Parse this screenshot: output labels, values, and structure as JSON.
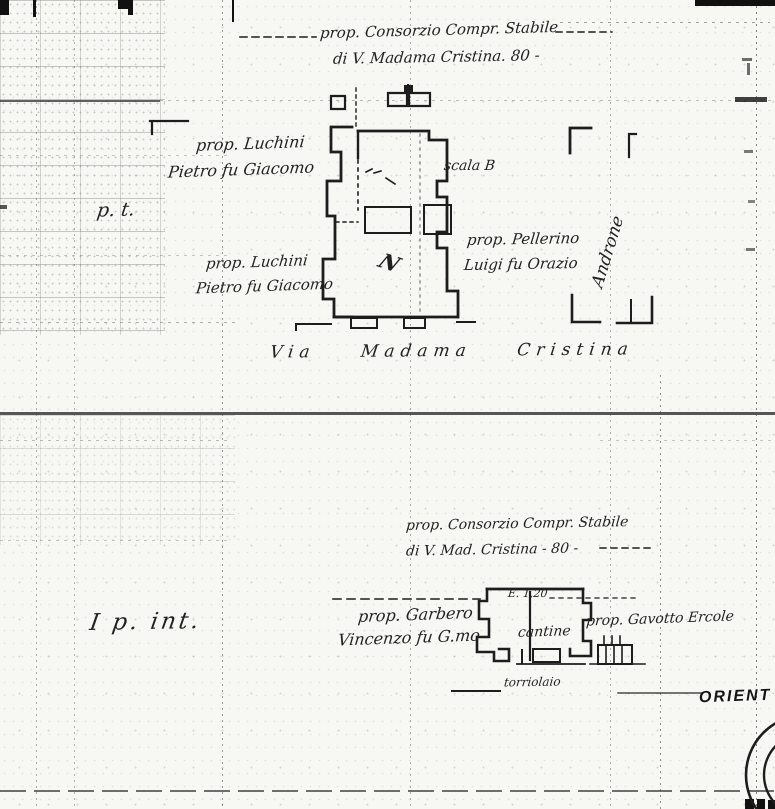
{
  "page": {
    "background": "#f7f7f4",
    "ink": "#262626",
    "type_note": "scanned cadastral plan"
  },
  "labels": {
    "top_property_1": "prop. Consorzio Compr. Stabile",
    "top_property_2": "di V. Madama Cristina. 80 -",
    "luchini_upper_1": "prop. Luchini",
    "luchini_upper_2": "Pietro fu Giacomo",
    "scala_b": "scala B",
    "piano_terra": "p. t.",
    "luchini_lower_1": "prop. Luchini",
    "luchini_lower_2": "Pietro fu Giacomo",
    "pellerino_1": "prop. Pellerino",
    "pellerino_2": "Luigi fu Orazio",
    "androne": "Androne",
    "via_madama_cristina": "Via Madama Cristina",
    "bottom_property_1": "prop. Consorzio Compr. Stabile",
    "bottom_property_2": "di V. Mad. Cristina - 80 -",
    "quota": "E. 1,20",
    "garbero_1": "prop. Garbero",
    "garbero_2": "Vincenzo fu G.mo",
    "cantine": "cantine",
    "gavotto": "prop. Gavotto Ercole",
    "torriolaio": "torriolaio",
    "piano_interrato": "I p. int.",
    "building_mark_n": "N",
    "orient": "ORIENT"
  }
}
